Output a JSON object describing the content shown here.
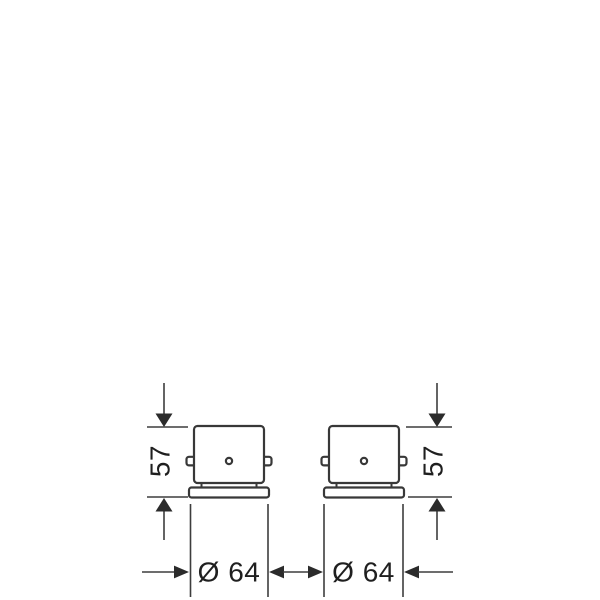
{
  "drawing": {
    "left_fixture": {
      "height_label": "57",
      "diameter_label": "Ø 64"
    },
    "right_fixture": {
      "height_label": "57",
      "diameter_label": "Ø 64"
    }
  }
}
